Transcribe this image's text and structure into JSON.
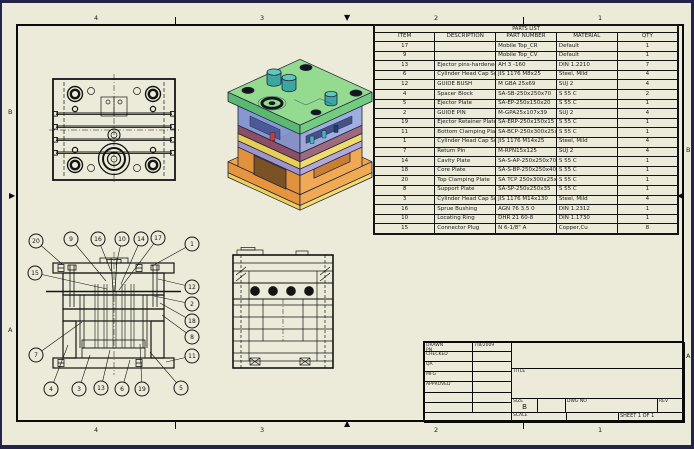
{
  "sheet": {
    "zones": {
      "top": [
        "4",
        "3",
        "2",
        "1"
      ],
      "bottom": [
        "4",
        "3",
        "2",
        "1"
      ],
      "left": [
        "B",
        "A"
      ],
      "right": [
        "B",
        "A"
      ]
    },
    "icons": {
      "fold_down": "▼",
      "fold_up": "▲",
      "fold_right": "▶",
      "fold_left": "◀"
    }
  },
  "colors": {
    "paper": "#ecebd9",
    "outer_border": "#242449",
    "line": "#141414",
    "iso_green_top": "#8fd98b",
    "iso_green_side": "#5cb871",
    "iso_blue": "#7e8fd0",
    "iso_blue_light": "#98a8e2",
    "iso_maroon": "#8c4f63",
    "iso_yellow": "#e6cf52",
    "iso_lavender": "#9f93cc",
    "iso_orange": "#e2923c",
    "iso_orange_light": "#f0a954",
    "iso_teal": "#3aa8a0",
    "iso_dark": "#1c2240"
  },
  "parts_list": {
    "title": "PARTS LIST",
    "columns": [
      "ITEM",
      "DESCRIPTION",
      "PART NUMBER",
      "MATERIAL",
      "QTY"
    ],
    "rows": [
      [
        "17",
        "",
        "Mobile Top_CR",
        "Default",
        "1"
      ],
      [
        "9",
        "",
        "Mobile Top_CV",
        "Default",
        "1"
      ],
      [
        "13",
        "Ejector pins-hardened",
        "AH 3 -160",
        "DIN 1.2210",
        "7"
      ],
      [
        "6",
        "Cylinder Head Cap Screw",
        "JIS 1176 M8x25",
        "Steel, Mild",
        "4"
      ],
      [
        "12",
        "GUIDE BUSH",
        "M GBA 25x69",
        "SUJ 2",
        "4"
      ],
      [
        "4",
        "Spacer Block",
        "SA-SB-250x250x70",
        "S 55 C",
        "2"
      ],
      [
        "5",
        "Ejector Plate",
        "SA-EP-250x150x20",
        "S 55 C",
        "1"
      ],
      [
        "2",
        "GUIDE PIN",
        "M-GPA25x107x39",
        "SUJ 2",
        "4"
      ],
      [
        "19",
        "Ejector Retainer Plate",
        "SA-ERP-250x150x15",
        "S 55 C",
        "1"
      ],
      [
        "11",
        "Bottom Clamping Plate",
        "SA-BCP-250x300x25x200",
        "S 55 C",
        "1"
      ],
      [
        "1",
        "Cylinder Head Cap Screw",
        "JIS 1176 M14x25",
        "Steel, Mild",
        "4"
      ],
      [
        "7",
        "Return Pin",
        "M-RPN15x125",
        "SUJ 2",
        "4"
      ],
      [
        "14",
        "Cavity Plate",
        "SA-S-AP-250x250x70",
        "S 55 C",
        "1"
      ],
      [
        "18",
        "Core Plate",
        "SA-S-BP-250x250x40",
        "S 55 C",
        "1"
      ],
      [
        "20",
        "Top Clamping Plate",
        "SA TCP 250x300x25x200",
        "S 55 C",
        "1"
      ],
      [
        "8",
        "Support Plate",
        "SA-SP-250x250x35",
        "S 55 C",
        "1"
      ],
      [
        "3",
        "Cylinder Head Cap Screw",
        "JIS 1176 M14x130",
        "Steel, Mild",
        "4"
      ],
      [
        "16",
        "Sprue Bushing",
        "AGN 76 3.5 0",
        "DIN 1.2312",
        "1"
      ],
      [
        "10",
        "Locating Ring",
        "DHR 21 60-8",
        "DIN 1.1730",
        "1"
      ],
      [
        "15",
        "Connector Plug",
        "N 6-1/8\" A",
        "Copper,Cu",
        "8"
      ]
    ]
  },
  "title_block": {
    "drawn_label": "DRAWN",
    "drawn_by": "PN",
    "drawn_date": "7/8/2009",
    "checked_label": "CHECKED",
    "qa_label": "QA",
    "mfg_label": "MFG",
    "approved_label": "APPROVED",
    "title_label": "TITLE",
    "size_label": "SIZE",
    "size_value": "B",
    "dwg_no_label": "DWG NO",
    "rev_label": "REV",
    "scale_label": "SCALE",
    "sheet_text": "SHEET 1 OF 1"
  },
  "front_view": {
    "balloons": [
      {
        "n": "20",
        "x": 36,
        "y": 241,
        "tx": 62,
        "ty": 264
      },
      {
        "n": "9",
        "x": 71,
        "y": 239,
        "tx": 106,
        "ty": 281
      },
      {
        "n": "16",
        "x": 98,
        "y": 239,
        "tx": 111,
        "ty": 271
      },
      {
        "n": "10",
        "x": 122,
        "y": 239,
        "tx": 116,
        "ty": 265
      },
      {
        "n": "14",
        "x": 141,
        "y": 239,
        "tx": 121,
        "ty": 284
      },
      {
        "n": "17",
        "x": 158,
        "y": 238,
        "tx": 119,
        "ty": 290
      },
      {
        "n": "1",
        "x": 192,
        "y": 244,
        "tx": 152,
        "ty": 266
      },
      {
        "n": "15",
        "x": 35,
        "y": 273,
        "tx": 107,
        "ty": 289
      },
      {
        "n": "12",
        "x": 192,
        "y": 287,
        "tx": 158,
        "ty": 279
      },
      {
        "n": "2",
        "x": 192,
        "y": 304,
        "tx": 154,
        "ty": 296
      },
      {
        "n": "18",
        "x": 192,
        "y": 321,
        "tx": 160,
        "ty": 303
      },
      {
        "n": "8",
        "x": 192,
        "y": 337,
        "tx": 162,
        "ty": 315
      },
      {
        "n": "11",
        "x": 192,
        "y": 356,
        "tx": 166,
        "ty": 362
      },
      {
        "n": "7",
        "x": 36,
        "y": 355,
        "tx": 82,
        "ty": 322
      },
      {
        "n": "4",
        "x": 51,
        "y": 389,
        "tx": 68,
        "ty": 345
      },
      {
        "n": "3",
        "x": 79,
        "y": 389,
        "tx": 90,
        "ty": 355
      },
      {
        "n": "13",
        "x": 101,
        "y": 388,
        "tx": 110,
        "ty": 350
      },
      {
        "n": "6",
        "x": 122,
        "y": 389,
        "tx": 130,
        "ty": 360
      },
      {
        "n": "19",
        "x": 142,
        "y": 389,
        "tx": 140,
        "ty": 344
      },
      {
        "n": "5",
        "x": 181,
        "y": 388,
        "tx": 150,
        "ty": 352
      }
    ]
  }
}
